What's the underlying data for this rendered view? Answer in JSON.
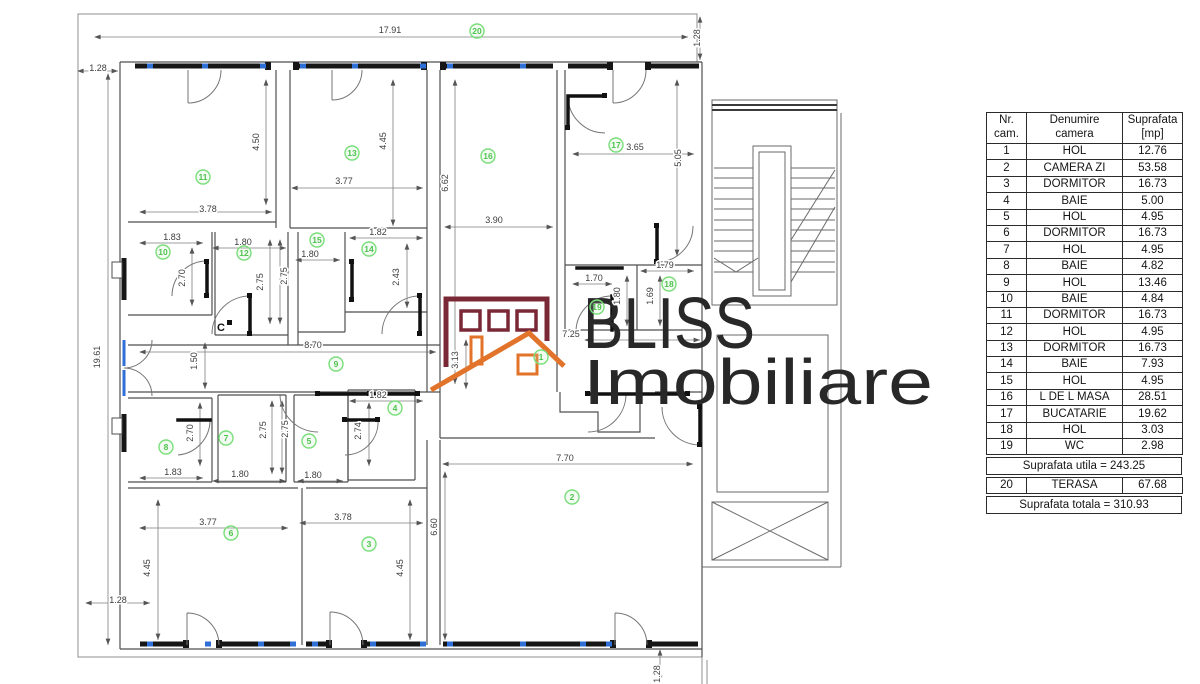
{
  "table": {
    "col_headers": [
      [
        "Nr.",
        "cam."
      ],
      [
        "Denumire",
        "camera"
      ],
      [
        "Suprafata",
        "[mp]"
      ]
    ],
    "rows": [
      [
        "1",
        "HOL",
        "12.76"
      ],
      [
        "2",
        "CAMERA ZI",
        "53.58"
      ],
      [
        "3",
        "DORMITOR",
        "16.73"
      ],
      [
        "4",
        "BAIE",
        "5.00"
      ],
      [
        "5",
        "HOL",
        "4.95"
      ],
      [
        "6",
        "DORMITOR",
        "16.73"
      ],
      [
        "7",
        "HOL",
        "4.95"
      ],
      [
        "8",
        "BAIE",
        "4.82"
      ],
      [
        "9",
        "HOL",
        "13.46"
      ],
      [
        "10",
        "BAIE",
        "4.84"
      ],
      [
        "11",
        "DORMITOR",
        "16.73"
      ],
      [
        "12",
        "HOL",
        "4.95"
      ],
      [
        "13",
        "DORMITOR",
        "16.73"
      ],
      [
        "14",
        "BAIE",
        "7.93"
      ],
      [
        "15",
        "HOL",
        "4.95"
      ],
      [
        "16",
        "L DE L MASA",
        "28.51"
      ],
      [
        "17",
        "BUCATARIE",
        "19.62"
      ],
      [
        "18",
        "HOL",
        "3.03"
      ],
      [
        "19",
        "WC",
        "2.98"
      ]
    ],
    "subtotal": "Suprafata utila = 243.25",
    "terasa_row": [
      "20",
      "TERASA",
      "67.68"
    ],
    "total": "Suprafata totala = 310.93"
  },
  "logo": {
    "line1": "BLISS",
    "line2": "Imobiliare"
  },
  "colors": {
    "wall_thick": "#161616",
    "wall_thin": "#5a5a5a",
    "window_accent": "#2f6fd6",
    "badge_green": "#7ade7a",
    "logo_maroon": "#7a2836",
    "logo_orange": "#e2732a"
  },
  "floorplan": {
    "room_badges": [
      {
        "n": "20",
        "x": 477,
        "y": 31
      },
      {
        "n": "11",
        "x": 203,
        "y": 177
      },
      {
        "n": "13",
        "x": 352,
        "y": 153
      },
      {
        "n": "16",
        "x": 488,
        "y": 156
      },
      {
        "n": "17",
        "x": 616,
        "y": 145
      },
      {
        "n": "10",
        "x": 163,
        "y": 252
      },
      {
        "n": "12",
        "x": 244,
        "y": 253
      },
      {
        "n": "15",
        "x": 317,
        "y": 240
      },
      {
        "n": "14",
        "x": 369,
        "y": 249
      },
      {
        "n": "9",
        "x": 336,
        "y": 364
      },
      {
        "n": "18",
        "x": 669,
        "y": 284
      },
      {
        "n": "19",
        "x": 597,
        "y": 307
      },
      {
        "n": "1",
        "x": 541,
        "y": 357
      },
      {
        "n": "8",
        "x": 166,
        "y": 447
      },
      {
        "n": "7",
        "x": 226,
        "y": 438
      },
      {
        "n": "5",
        "x": 309,
        "y": 441
      },
      {
        "n": "4",
        "x": 395,
        "y": 408
      },
      {
        "n": "6",
        "x": 231,
        "y": 533
      },
      {
        "n": "3",
        "x": 369,
        "y": 544
      },
      {
        "n": "2",
        "x": 572,
        "y": 497
      }
    ],
    "dimensions": [
      {
        "t": "17.91",
        "x": 390,
        "y": 33,
        "r": 0
      },
      {
        "t": "1.28",
        "x": 98,
        "y": 71,
        "r": 0
      },
      {
        "t": "1.28",
        "x": 700,
        "y": 38,
        "r": 90
      },
      {
        "t": "19.61",
        "x": 100,
        "y": 357,
        "r": 90
      },
      {
        "t": "1.28",
        "x": 118,
        "y": 603,
        "r": 0
      },
      {
        "t": "1.28",
        "x": 660,
        "y": 674,
        "r": 90
      },
      {
        "t": "3.78",
        "x": 208,
        "y": 212,
        "r": 0
      },
      {
        "t": "4.50",
        "x": 259,
        "y": 142,
        "r": 90
      },
      {
        "t": "3.77",
        "x": 344,
        "y": 184,
        "r": 0
      },
      {
        "t": "4.45",
        "x": 386,
        "y": 141,
        "r": 90
      },
      {
        "t": "3.90",
        "x": 494,
        "y": 223,
        "r": 0
      },
      {
        "t": "6.62",
        "x": 448,
        "y": 183,
        "r": 90
      },
      {
        "t": "3.65",
        "x": 635,
        "y": 150,
        "r": 0
      },
      {
        "t": "5.05",
        "x": 681,
        "y": 158,
        "r": 90
      },
      {
        "t": "1.83",
        "x": 172,
        "y": 240,
        "r": 0
      },
      {
        "t": "2.70",
        "x": 185,
        "y": 278,
        "r": 90
      },
      {
        "t": "1.80",
        "x": 243,
        "y": 245,
        "r": 0
      },
      {
        "t": "2.75",
        "x": 263,
        "y": 282,
        "r": 90
      },
      {
        "t": "1.80",
        "x": 310,
        "y": 257,
        "r": 0
      },
      {
        "t": "2.75",
        "x": 287,
        "y": 276,
        "r": 90
      },
      {
        "t": "1.82",
        "x": 378,
        "y": 235,
        "r": 0
      },
      {
        "t": "2.43",
        "x": 399,
        "y": 277,
        "r": 90
      },
      {
        "t": "1.70",
        "x": 594,
        "y": 281,
        "r": 0
      },
      {
        "t": "1.79",
        "x": 665,
        "y": 268,
        "r": 0
      },
      {
        "t": "1.80",
        "x": 620,
        "y": 296,
        "r": 90
      },
      {
        "t": "1.69",
        "x": 653,
        "y": 296,
        "r": 90
      },
      {
        "t": "8.70",
        "x": 313,
        "y": 348,
        "r": 0
      },
      {
        "t": "1.50",
        "x": 197,
        "y": 361,
        "r": 90
      },
      {
        "t": "7.25",
        "x": 571,
        "y": 337,
        "r": 0
      },
      {
        "t": "3.13",
        "x": 458,
        "y": 360,
        "r": 90
      },
      {
        "t": "1.83",
        "x": 173,
        "y": 475,
        "r": 0
      },
      {
        "t": "2.70",
        "x": 193,
        "y": 433,
        "r": 90
      },
      {
        "t": "1.80",
        "x": 240,
        "y": 477,
        "r": 0
      },
      {
        "t": "2.75",
        "x": 266,
        "y": 430,
        "r": 90
      },
      {
        "t": "1.80",
        "x": 313,
        "y": 478,
        "r": 0
      },
      {
        "t": "2.75",
        "x": 288,
        "y": 429,
        "r": 90
      },
      {
        "t": "1.82",
        "x": 378,
        "y": 398,
        "r": 0
      },
      {
        "t": "2.74",
        "x": 361,
        "y": 431,
        "r": 90
      },
      {
        "t": "3.77",
        "x": 208,
        "y": 525,
        "r": 0
      },
      {
        "t": "3.78",
        "x": 343,
        "y": 520,
        "r": 0
      },
      {
        "t": "4.45",
        "x": 150,
        "y": 568,
        "r": 90
      },
      {
        "t": "4.45",
        "x": 403,
        "y": 568,
        "r": 90
      },
      {
        "t": "7.70",
        "x": 565,
        "y": 461,
        "r": 0
      },
      {
        "t": "6.60",
        "x": 437,
        "y": 527,
        "r": 90
      }
    ],
    "annotations": [
      {
        "t": "C",
        "x": 221,
        "y": 331
      }
    ]
  }
}
